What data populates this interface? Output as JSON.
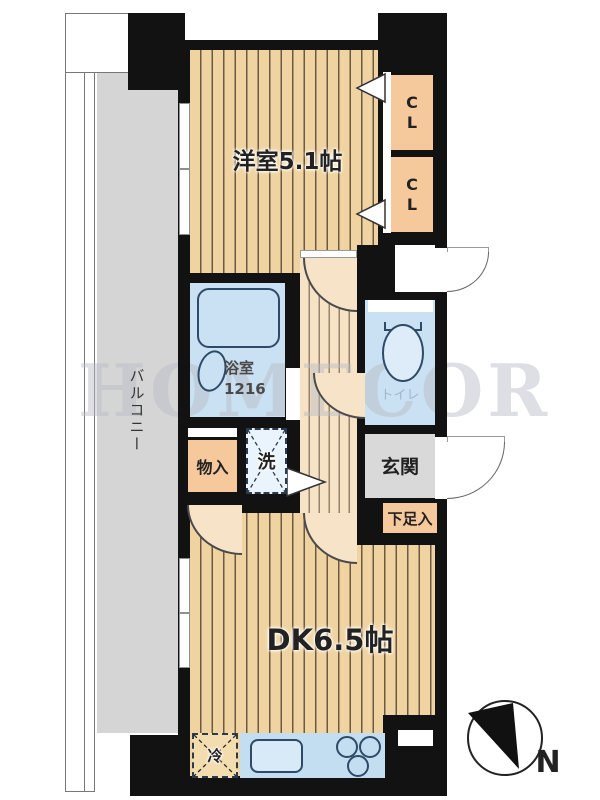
{
  "plan": {
    "rooms": {
      "western": {
        "label": "洋室5.1帖"
      },
      "dk": {
        "label": "DK6.5帖"
      },
      "balcony": {
        "label": "バルコニー"
      },
      "bath": {
        "label": "浴室",
        "size": "1216"
      },
      "toilet": {
        "label": "トイレ"
      },
      "entrance": {
        "label": "玄関"
      },
      "shoe_cabinet": {
        "label": "下足入"
      },
      "storage": {
        "label": "物入"
      },
      "closet_upper": {
        "label": "CL"
      },
      "closet_lower": {
        "label": "CL"
      },
      "washer": {
        "label": "洗"
      },
      "refrigerator": {
        "label": "冷"
      }
    },
    "compass": {
      "north_label": "N"
    },
    "watermark": {
      "text": "HOMECOR"
    },
    "colors": {
      "wall": "#121212",
      "floor_wood": "#efd4a2",
      "floor_light": "#f6e2c4",
      "closet_peach": "#f6c99c",
      "water_blue": "#c9e1f2",
      "kitchen_blue": "#c3ddf1",
      "balcony_gray": "#d5d5d5",
      "entrance_gray": "#d9d9d9"
    }
  }
}
